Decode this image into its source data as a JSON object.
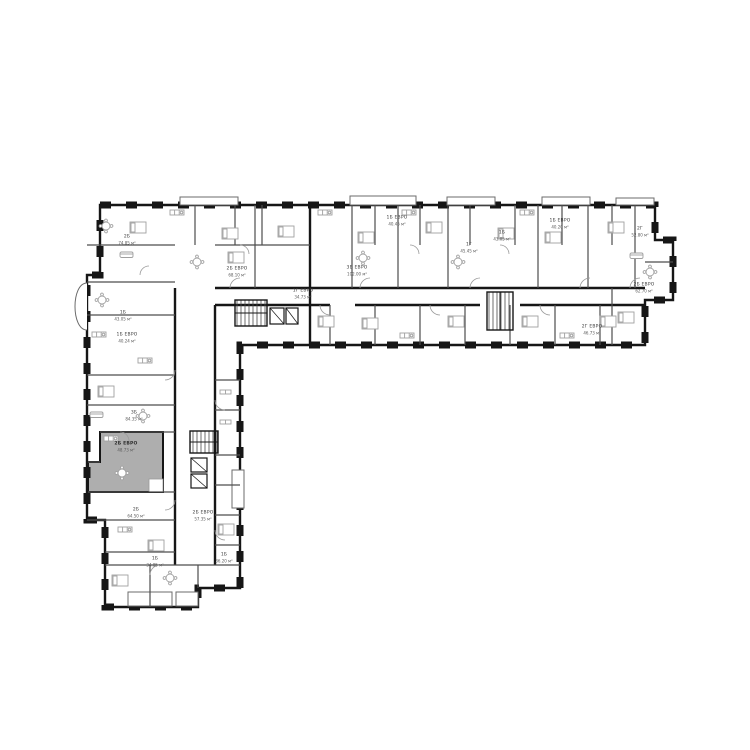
{
  "plan": {
    "colors": {
      "background": "#ffffff",
      "wall": "#161616",
      "partition": "#4d4d4d",
      "furniture": "#a0a0a0",
      "door": "#9a9a9a",
      "highlight": "#aeaeae",
      "label": "#3a3a3a"
    },
    "area_unit": "м²"
  },
  "selected_unit": {
    "type": "2Б ЕВРО",
    "area": "48.73 м²"
  },
  "units": [
    {
      "type": "2Б",
      "area": "74.85 м²",
      "x": 127,
      "y": 240
    },
    {
      "type": "2Б ЕВРО",
      "area": "68.10 м²",
      "x": 237,
      "y": 272
    },
    {
      "type": "1Б",
      "area": "43.05 м²",
      "x": 123,
      "y": 316
    },
    {
      "type": "1Б ЕВРО",
      "area": "40.24 м²",
      "x": 127,
      "y": 338
    },
    {
      "type": "1Г ЕВРО",
      "area": "34.73 м²",
      "x": 303,
      "y": 294
    },
    {
      "type": "3Б ЕВРО",
      "area": "102.00 м²",
      "x": 357,
      "y": 271
    },
    {
      "type": "1Б ЕВРО",
      "area": "40.45 м²",
      "x": 397,
      "y": 221
    },
    {
      "type": "1Г",
      "area": "45.45 м²",
      "x": 469,
      "y": 248
    },
    {
      "type": "1Б",
      "area": "43.05 м²",
      "x": 502,
      "y": 236
    },
    {
      "type": "1Б ЕВРО",
      "area": "40.20 м²",
      "x": 560,
      "y": 224
    },
    {
      "type": "2Г",
      "area": "52.80 м²",
      "x": 640,
      "y": 232
    },
    {
      "type": "2Б ЕВРО",
      "area": "62.70 м²",
      "x": 644,
      "y": 288
    },
    {
      "type": "2Г ЕВРО",
      "area": "46.73 м²",
      "x": 592,
      "y": 330
    },
    {
      "type": "3Б",
      "area": "84.35 м²",
      "x": 134,
      "y": 416
    },
    {
      "type": "2Б ЕВРО",
      "area": "48.73 м²",
      "x": 126,
      "y": 447,
      "selected": true
    },
    {
      "type": "2Б",
      "area": "64.50 м²",
      "x": 136,
      "y": 513
    },
    {
      "type": "2Б ЕВРО",
      "area": "57.35 м²",
      "x": 203,
      "y": 516
    },
    {
      "type": "1Б",
      "area": "34.85 м²",
      "x": 155,
      "y": 562
    },
    {
      "type": "1Б",
      "area": "36.20 м²",
      "x": 224,
      "y": 558
    }
  ]
}
